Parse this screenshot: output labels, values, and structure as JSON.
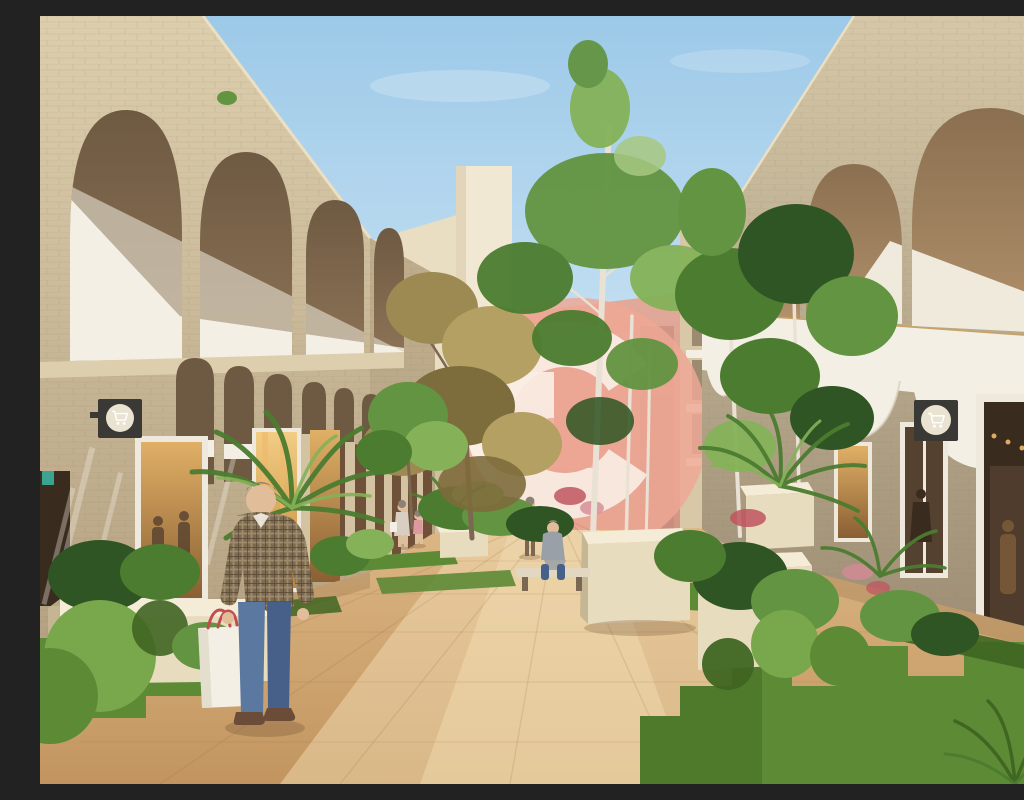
{
  "meta": {
    "description": "Sunlit architectural rendering of a pedestrian shopping street: two sandstone arched buildings flank a travertine walkway with planters, palms and trees; a man carries shopping bags in the foreground; a salmon circular G-monogram watermark overlays the centre; two square shop signs display shopping-cart icons.",
    "visible_people_count": 5,
    "shop_sign_count": 2
  },
  "signs": {
    "left": {
      "icon": "shopping-cart"
    },
    "right": {
      "icon": "shopping-cart"
    }
  },
  "watermark": {
    "shape": "circle-with-G-monogram"
  },
  "colors": {
    "sky_top": "#9cc9e8",
    "sky_low": "#e2f0f9",
    "cloud": "#ffffff",
    "stone_left": "#cdbb9b",
    "stone_left_light": "#ddcfae",
    "stone_left_dark": "#b3a080",
    "stone_right": "#c0b296",
    "stone_right_light": "#d5c7a7",
    "stone_right_dark": "#9d8e75",
    "brick_line": "#8f7f63",
    "gold_line": "#c9a265",
    "roof_edge": "#ecdfc2",
    "arch_top": "#6e5a42",
    "arch_bottom": "#8d7356",
    "arch_r_top": "#8a6f50",
    "arch_r_bottom": "#b2916b",
    "parapet_white": "#f3efe4",
    "parapet_shadow": "#d9d2c0",
    "colonnade_dark": "#6e5138",
    "column_light": "#d3c3a3",
    "bg_cream": "#e9ddc2",
    "bg_cream2": "#f1e8d4",
    "bg_tan": "#d8c8a8",
    "bg_far": "#cfbf9e",
    "pink_top": "#e2aa9a",
    "pink_bottom": "#cf9282",
    "pink_dark": "#c08373",
    "wm_pink": "#efa795",
    "wm_white": "#fdf6ee",
    "floor_far": "#dcb684",
    "floor_near": "#c2955f",
    "floor_hot": "#f6e3ba",
    "seam": "#8a6a44",
    "grass": "#5d8a35",
    "grass_dark": "#3f6522",
    "grass_light": "#79a74b",
    "leaf_dark": "#2f5524",
    "leaf": "#4c7c30",
    "leaf_mid": "#639441",
    "leaf_light": "#85b258",
    "leaf_pale": "#a7c87b",
    "olive": "#9c8a52",
    "olive_dark": "#7d6c3c",
    "olive_light": "#b4a062",
    "trunk_birch": "#e9e2d4",
    "trunk_dark": "#7c6852",
    "flower_red": "#c05560",
    "flower_pink": "#d58a96",
    "planter": "#e8dcbe",
    "planter_top": "#f4ecd6",
    "planter_side": "#c6b794",
    "window_warm_top": "#e0b066",
    "window_warm_bottom": "#8a5f33",
    "window_gold_top": "#f2cd84",
    "window_gold_bottom": "#c08736",
    "interior_dark": "#3a2b1f",
    "interior_dark2": "#55412f",
    "frame_white": "#eee9dc",
    "light_warm": "#f0b86a",
    "teal": "#3aa392",
    "sign_dark": "#3b3935",
    "sign_face": "#eae3d2",
    "cart_white": "#ffffff",
    "skin": "#e2bd9a",
    "hair_gray": "#8d8176",
    "shirt_base": "#7d6a50",
    "plaid_light": "#b9a783",
    "plaid_dark": "#4e3f2e",
    "jeans": "#5b79a0",
    "jeans_dark": "#46608a",
    "shoe": "#6b4c38",
    "bag_white": "#f4efe4",
    "bag_yellow": "#d2b944",
    "handle_red": "#c24d50",
    "coat_tan": "#c9b393",
    "coat_woman": "#d8cfc2",
    "child_pink": "#e098a0",
    "hoodie_gray": "#9aa0a8",
    "bench_wood": "#e2d8c2",
    "shadow": "#7a5a3a"
  }
}
